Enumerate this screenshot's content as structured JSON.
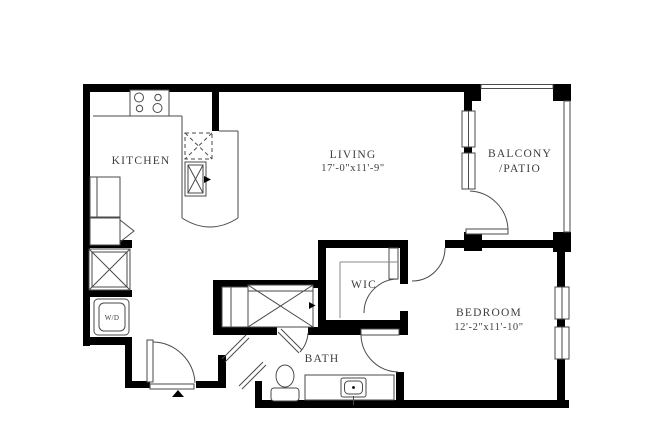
{
  "floor_plan": {
    "rooms": {
      "kitchen": {
        "label": "KITCHEN"
      },
      "living": {
        "label": "LIVING",
        "dimensions": "17'-0\"x11'-9\""
      },
      "balcony": {
        "label_line1": "BALCONY",
        "label_line2": "/PATIO"
      },
      "wic": {
        "label": "WIC"
      },
      "bedroom": {
        "label": "BEDROOM",
        "dimensions": "12'-2\"x11'-10\""
      },
      "bath": {
        "label": "BATH"
      },
      "laundry": {
        "label": "W/D"
      }
    },
    "colors": {
      "wall": "#000000",
      "fixture_line": "#4a4a4a",
      "text": "#3d3d3d",
      "background": "#ffffff"
    }
  }
}
